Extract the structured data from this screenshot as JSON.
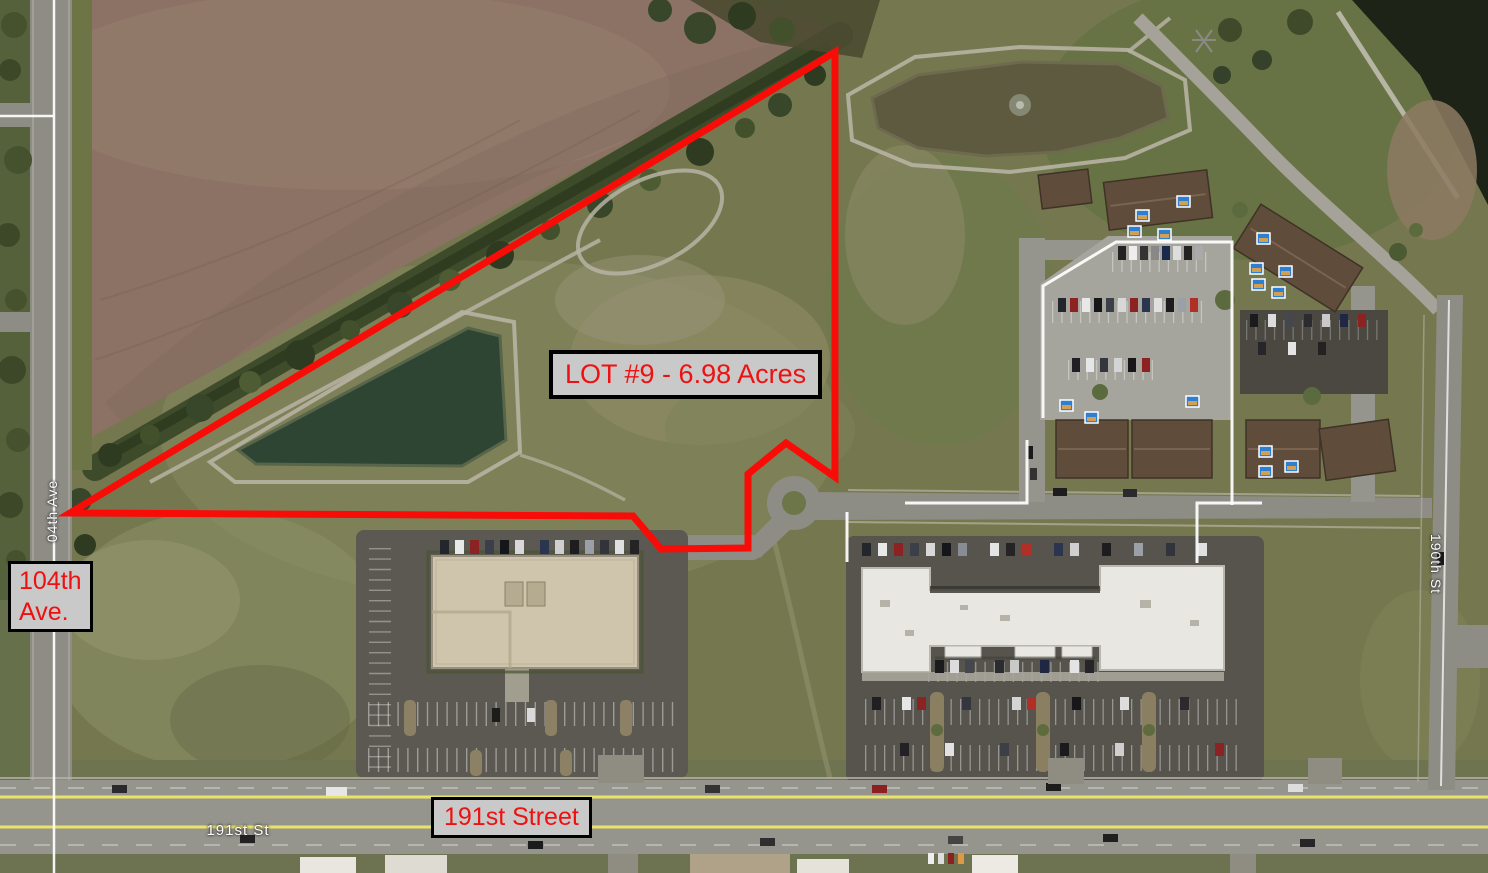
{
  "map": {
    "annotations": {
      "lot_label": "LOT #9 - 6.98 Acres",
      "left_road_label_line1": "104th",
      "left_road_label_line2": "Ave.",
      "bottom_road_label": "191st Street"
    },
    "street_names": {
      "left_vertical": "04th Ave",
      "right_vertical": "190th St",
      "bottom": "191st St"
    },
    "colors": {
      "annotation_red": "#f80c08",
      "label_background": "#c9c9c9",
      "label_border": "#000000",
      "label_text_red": "#ee1111",
      "field_brown": "#8b7265",
      "pond_green": "#2e4533",
      "pond_muddy": "#5e5a40",
      "road_gray": "#8e8d85",
      "lane_yellow": "#e9e26b",
      "boundary_white": "#fcfcfc"
    }
  }
}
